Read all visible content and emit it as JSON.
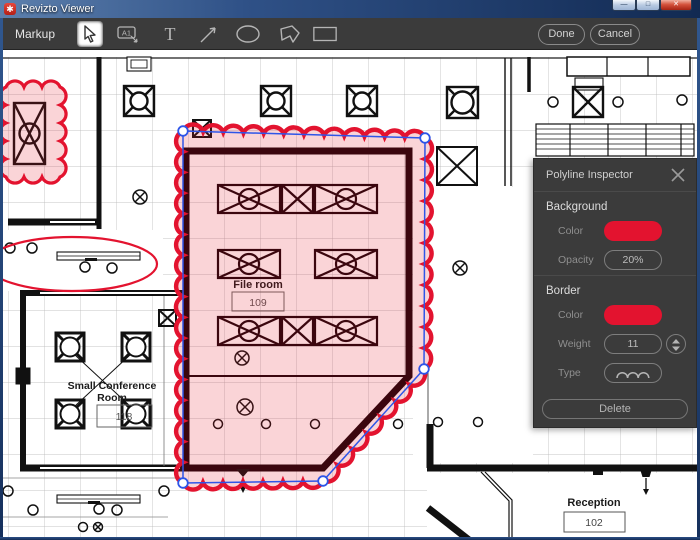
{
  "window": {
    "title": "Revizto Viewer"
  },
  "toolbar": {
    "markup_label": "Markup",
    "a1_label": "A1",
    "text_label": "T",
    "done_label": "Done",
    "cancel_label": "Cancel"
  },
  "inspector": {
    "title": "Polyline Inspector",
    "background": {
      "header": "Background",
      "color_label": "Color",
      "opacity_label": "Opacity",
      "opacity_value": "20%"
    },
    "border": {
      "header": "Border",
      "color_label": "Color",
      "weight_label": "Weight",
      "weight_value": "11",
      "type_label": "Type"
    },
    "delete_label": "Delete"
  },
  "plan": {
    "file_room": {
      "name": "File room",
      "number": "109"
    },
    "conference": {
      "line1": "Small Conference",
      "line2": "Room",
      "number": "118"
    },
    "reception": {
      "name": "Reception",
      "number": "102"
    }
  },
  "colors": {
    "markup_red": "#e3132f",
    "selection_blue": "#2e55e8",
    "fill_pink": "rgba(228,24,45,0.19)"
  }
}
